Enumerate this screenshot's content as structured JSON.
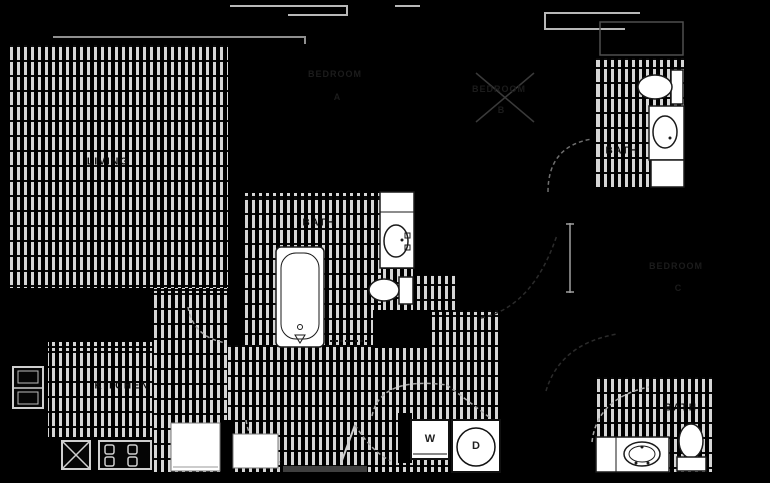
{
  "colors": {
    "background": "#000000",
    "hatch_stripe": "#d6d6d6",
    "wall": "#b8b8b8",
    "fixture_fill": "#ffffff",
    "fixture_stroke": "#1a1a1a",
    "room_label": "#0b0b0b",
    "faint_label": "#1c1c1c"
  },
  "rooms": {
    "living": {
      "label": "LIVING"
    },
    "kitchen": {
      "label": "KITCHEN"
    },
    "main_bath": {
      "label": "BATH"
    },
    "upper_right_bath": {
      "label": "BATH"
    },
    "lower_right_bath": {
      "label": "BATH"
    },
    "bedroom_a": {
      "label": "BEDROOM",
      "letter": "A"
    },
    "bedroom_b": {
      "label": "BEDROOM",
      "letter": "B"
    },
    "bedroom_c": {
      "label": "BEDROOM",
      "letter": "C"
    }
  },
  "appliances": {
    "washer_label": "W",
    "dryer_label": "D"
  },
  "icons": [
    "bathtub-icon",
    "toilet-icon",
    "sink-vanity-icon",
    "shower-base-icon",
    "range-burners-icon",
    "kitchen-sink-icon",
    "appliance-stack-icon",
    "refrigerator-icon",
    "pantry-icon",
    "door-swing-icon"
  ]
}
